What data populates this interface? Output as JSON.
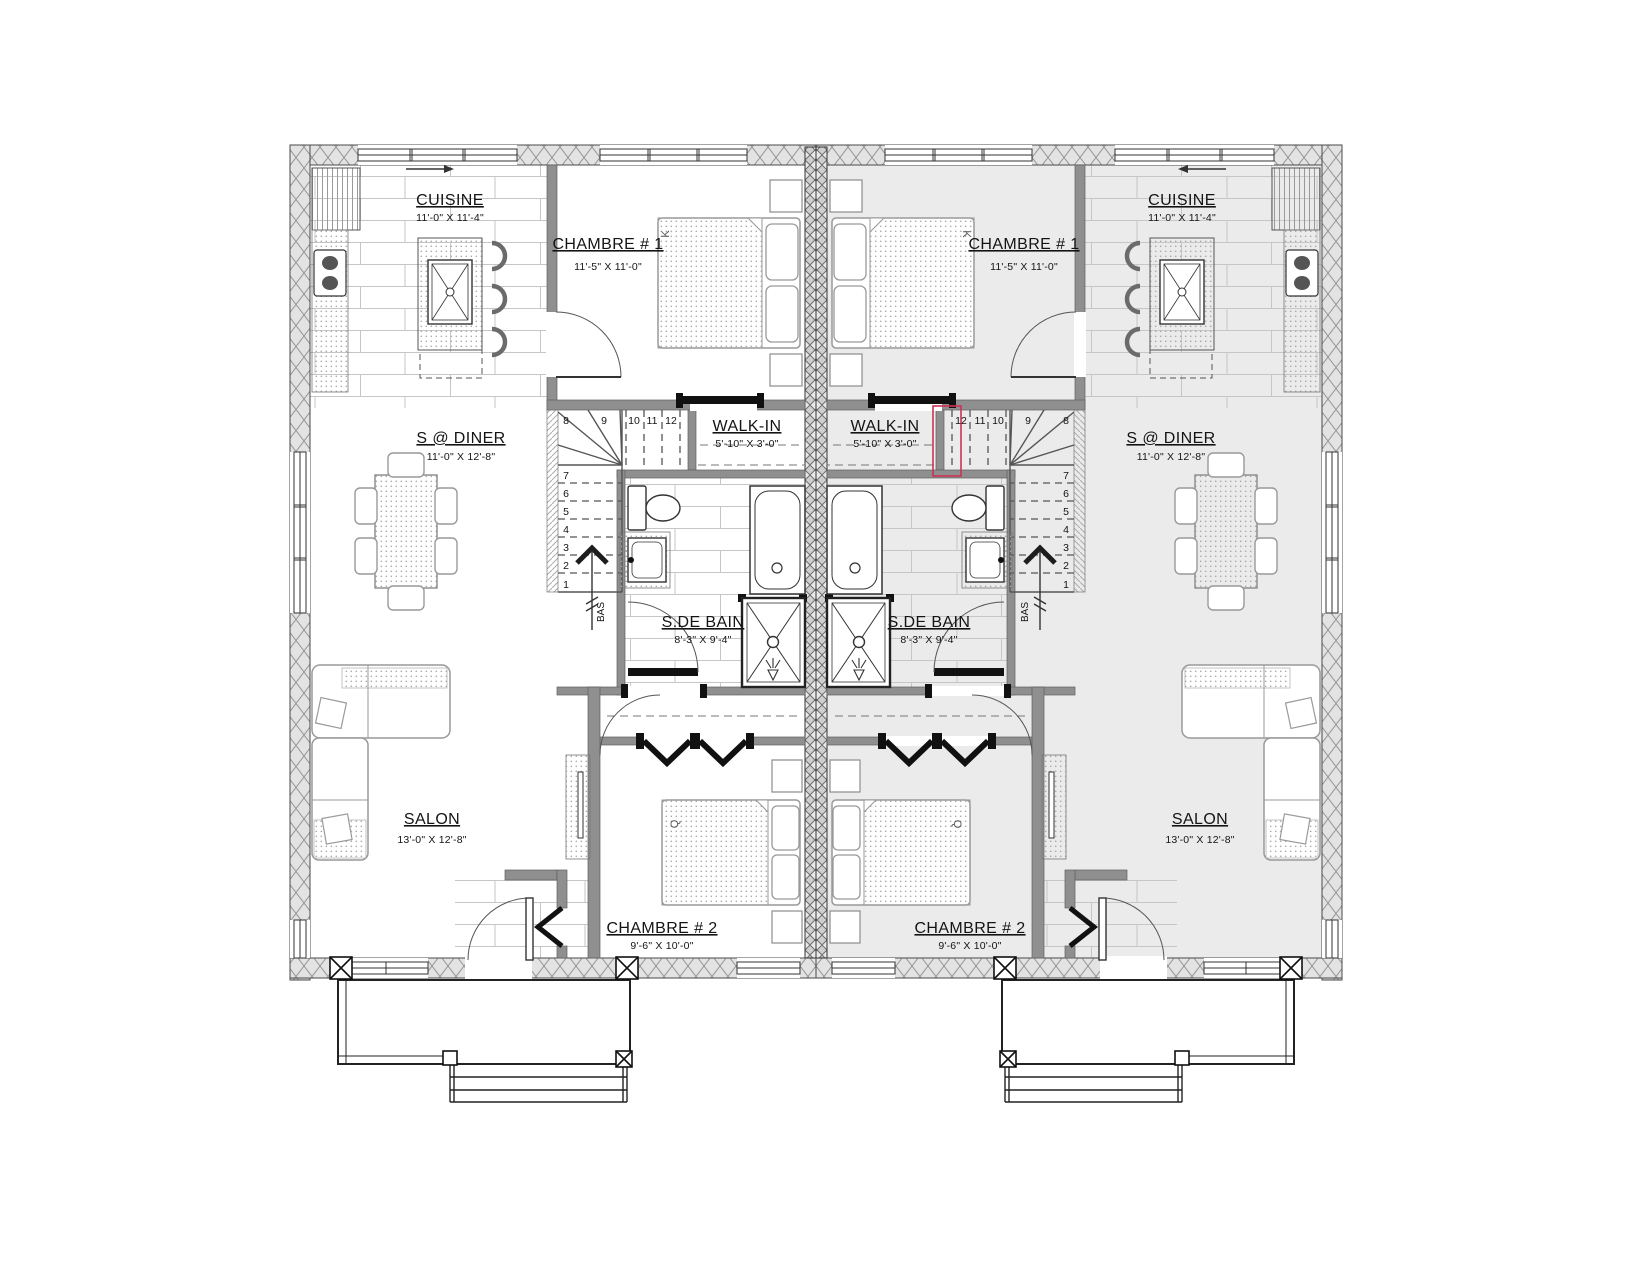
{
  "rooms": {
    "cuisine": {
      "name": "CUISINE",
      "dims": "11'-0\" X 11'-4\""
    },
    "chambre1": {
      "name": "CHAMBRE # 1",
      "dims": "11'-5\" X 11'-0\""
    },
    "sdiner": {
      "name": "S @ DINER",
      "dims": "11'-0\" X 12'-8\""
    },
    "walkin": {
      "name": "WALK-IN",
      "dims": "5'-10\" X 3'-0\""
    },
    "sdebain": {
      "name": "S.DE BAIN",
      "dims": "8'-3\" X 9'-4\""
    },
    "salon": {
      "name": "SALON",
      "dims": "13'-0\" X 12'-8\""
    },
    "chambre2": {
      "name": "CHAMBRE # 2",
      "dims": "9'-6\" X 10'-0\""
    }
  },
  "stairs": {
    "numbers": [
      "1",
      "2",
      "3",
      "4",
      "5",
      "6",
      "7",
      "8",
      "9",
      "10",
      "11",
      "12"
    ],
    "down_label": "BAS"
  },
  "beds": {
    "chambre1_size": "K",
    "chambre2_size": "Q"
  },
  "colors": {
    "right_unit_fill": "#ebebeb",
    "revision_mark": "#cc3355",
    "interior_wall": "#8f8f8f"
  }
}
